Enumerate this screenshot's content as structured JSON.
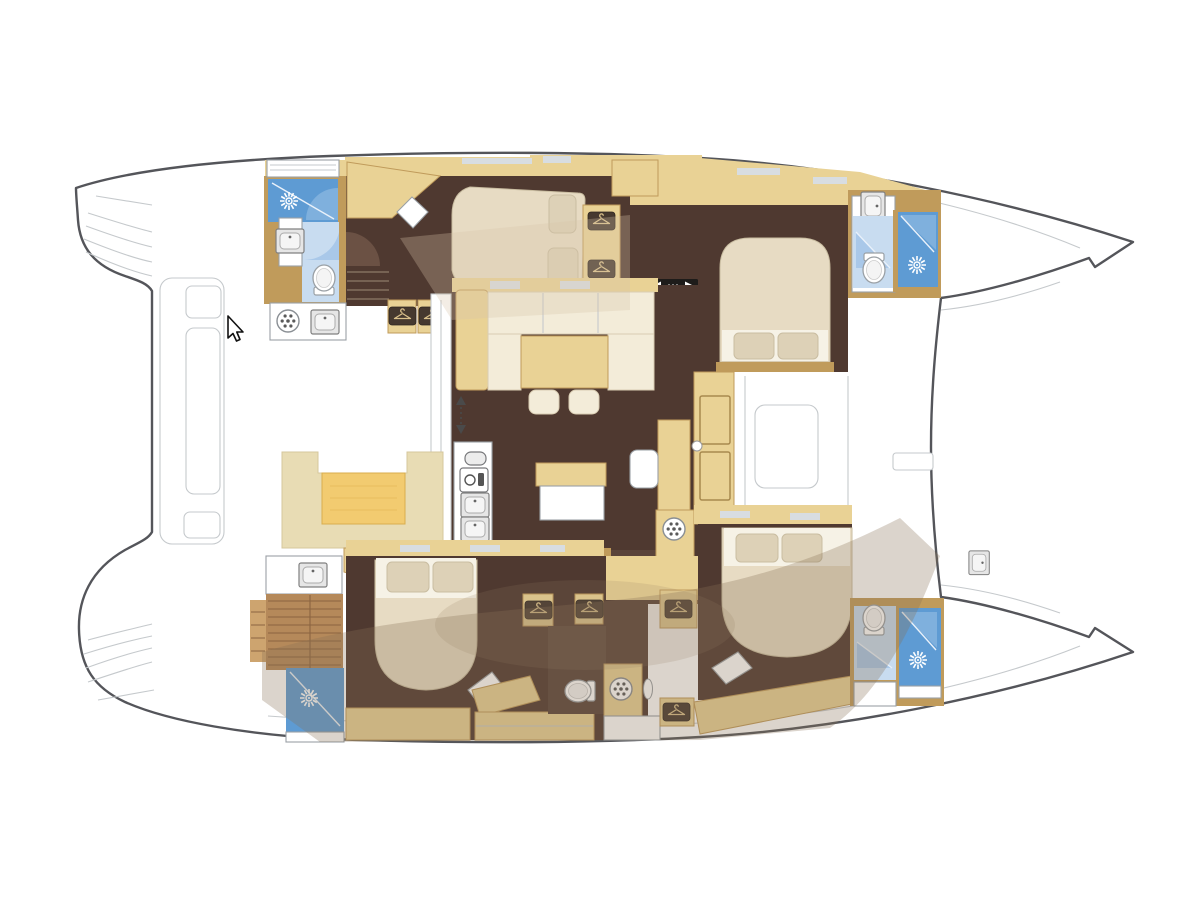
{
  "title": "Catamaran yacht interior floor plan, top-down view",
  "vessel": {
    "type": "catamaran",
    "view": "top-down deck plan",
    "orientation": "bows to the right, stern swim platforms to the left",
    "cabins": 4,
    "bathrooms": 4
  },
  "cursor": {
    "x": 228,
    "y": 316,
    "shape": "arrow-pointer"
  },
  "colors": {
    "page_bg": "#ffffff",
    "hull_line": "#54555a",
    "thin_line": "#c5c9cc",
    "wall": "#c09b5b",
    "tan": "#e9d295",
    "gold": "#f2cb70",
    "pale_seat": "#e8dcb4",
    "floor": "#4f3930",
    "floor_light": "#5a443a",
    "step_line": "#83705f",
    "slat": "#b5895a",
    "slat_line": "#8a6440",
    "bed_cream": "#e7dbc3",
    "bed_stroke": "#c9bda1",
    "sofa_cream": "#f3ecd9",
    "sofa_stroke": "#d9cdb2",
    "pillow": "#ddd1b7",
    "sheet_white": "#f6f2e6",
    "shower_blue": "#5e9bd3",
    "bath_blue": "#c8dcf0",
    "door_blue": "#a9c8e9",
    "glass_blue": "#7fb0dd",
    "door_brown": "#6b5144",
    "gray_stroke": "#9aa0a5",
    "appliance_stroke": "#77787b",
    "slit": "#d8dde1",
    "plaque": "#46392f",
    "hanger": "#d9c08b",
    "indicator_black": "#1e1c1a",
    "overlay_warm": "rgba(136,112,86,0.30)",
    "overlay_light": "rgba(214,196,168,0.30)"
  },
  "rooms": [
    {
      "id": "cockpit",
      "desc": "aft cockpit with U-shaped sofa and gold table"
    },
    {
      "id": "salon",
      "desc": "central salon with L-sofa, dining table and two stools"
    },
    {
      "id": "galley",
      "desc": "L-shaped galley with double sink, oven, 4-burner stove, round sink"
    },
    {
      "id": "port-aft-bathroom",
      "desc": "shower, washbasin, toilet"
    },
    {
      "id": "port-mid-cabin",
      "desc": "double bed placed diagonally"
    },
    {
      "id": "port-fwd-cabin",
      "desc": "double bed, wardrobes"
    },
    {
      "id": "port-fwd-bathroom",
      "desc": "washbasin, toilet, shower"
    },
    {
      "id": "stb-aft-bathroom",
      "desc": "washbasin, slatted stair, shower"
    },
    {
      "id": "stb-aft-cabin",
      "desc": "double bed with two pillows"
    },
    {
      "id": "stb-corridor",
      "desc": "wardrobes, toilet, washing machine"
    },
    {
      "id": "stb-fwd-cabin",
      "desc": "double bed with two pillows"
    },
    {
      "id": "stb-fwd-bathroom",
      "desc": "toilet, washbasin, shower"
    },
    {
      "id": "foredeck",
      "desc": "white bow deck between hulls"
    },
    {
      "id": "stern-platforms",
      "desc": "swim steps on both hulls"
    }
  ],
  "icons": [
    {
      "name": "shower-sun-icon",
      "meaning": "shower head",
      "count": 4
    },
    {
      "name": "washer-icon",
      "meaning": "washing machine / porthole drum",
      "count": 2
    },
    {
      "name": "fridge-icon",
      "meaning": "refrigerator units",
      "count": 2
    },
    {
      "name": "hanger-icon",
      "meaning": "wardrobe locker",
      "count": 8
    },
    {
      "name": "burner-icon",
      "meaning": "stove burner",
      "count": 4
    },
    {
      "name": "direction-arrows-icon",
      "meaning": "companionway steps down",
      "count": 1
    },
    {
      "name": "entry-arrows-icon",
      "meaning": "salon entry direction",
      "count": 1
    },
    {
      "name": "toilet-icon",
      "meaning": "toilet",
      "count": 4
    },
    {
      "name": "sink-icon",
      "meaning": "washbasin",
      "count": 6
    },
    {
      "name": "cursor-icon",
      "meaning": "mouse pointer",
      "count": 1
    }
  ]
}
